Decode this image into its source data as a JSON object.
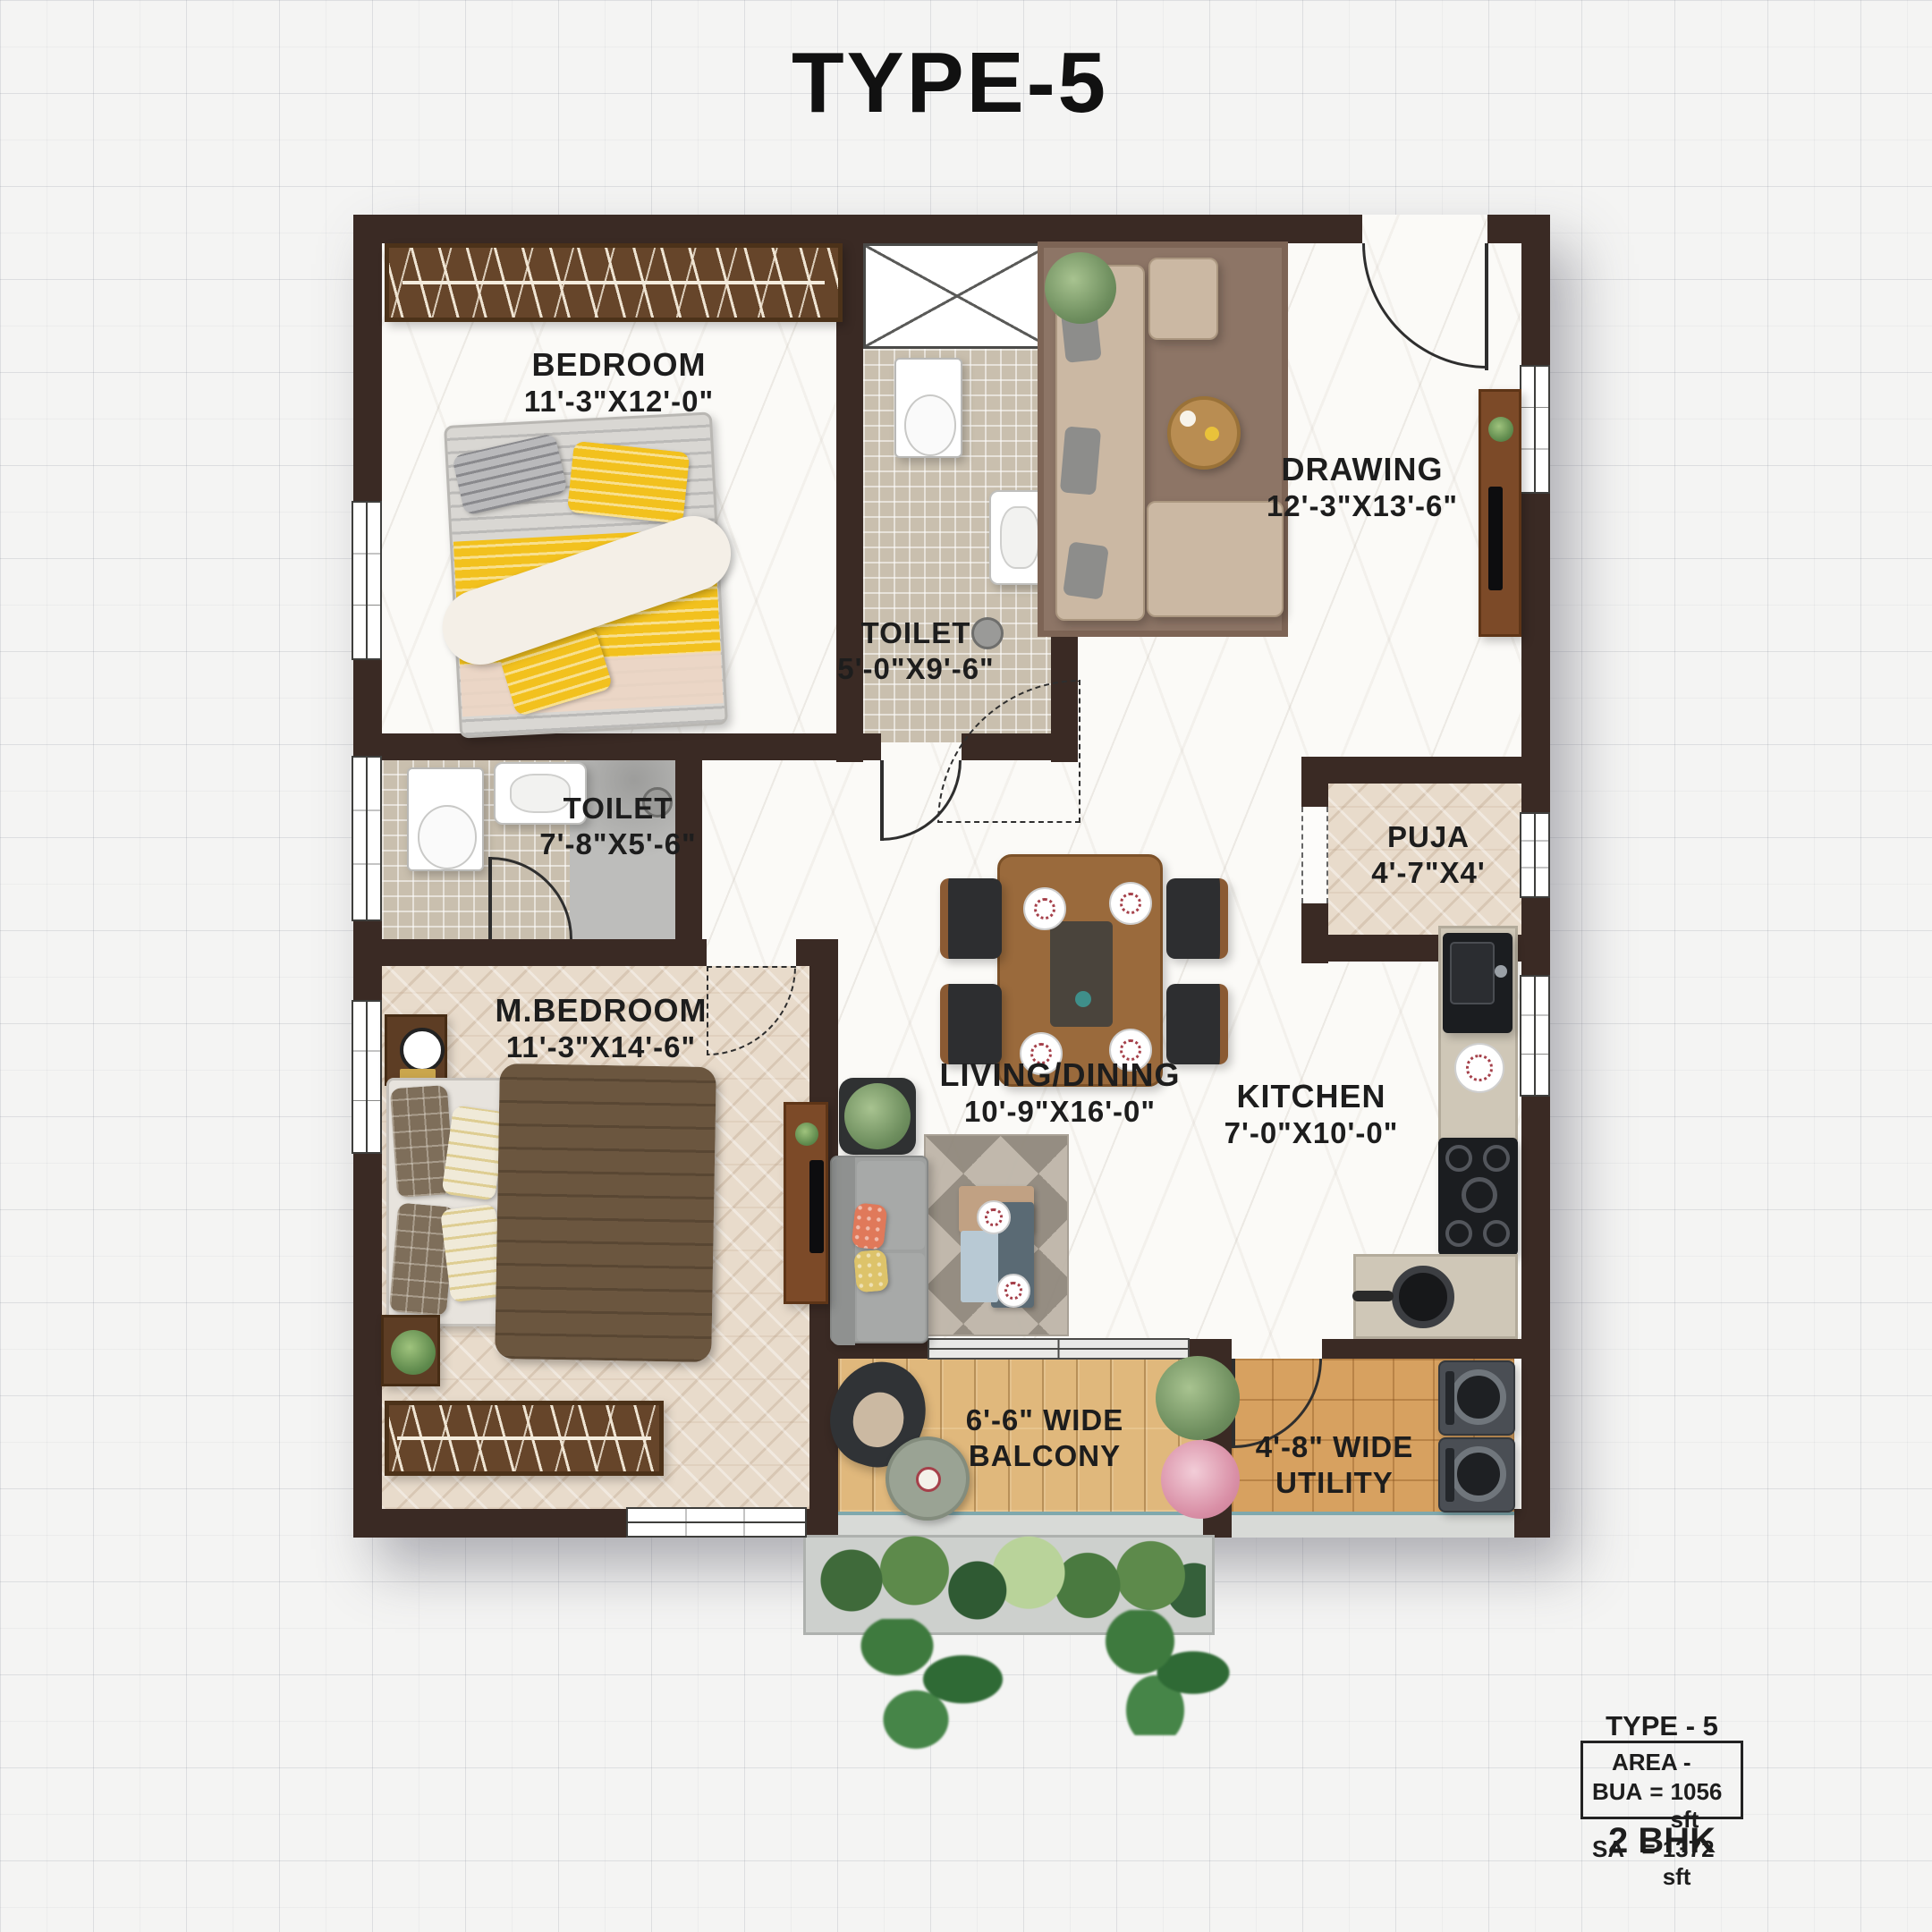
{
  "title": "TYPE-5",
  "rooms": {
    "bedroom": {
      "name": "BEDROOM",
      "dims": "11'-3\"X12'-0\""
    },
    "toilet_top": {
      "name": "TOILET",
      "dims": "5'-0\"X9'-6\""
    },
    "drawing": {
      "name": "DRAWING",
      "dims": "12'-3\"X13'-6\""
    },
    "toilet_left": {
      "name": "TOILET",
      "dims": "7'-8\"X5'-6\""
    },
    "puja": {
      "name": "PUJA",
      "dims": "4'-7\"X4'"
    },
    "master_bedroom": {
      "name": "M.BEDROOM",
      "dims": "11'-3\"X14'-6\""
    },
    "living_dining": {
      "name": "LIVING/DINING",
      "dims": "10'-9\"X16'-0\""
    },
    "kitchen": {
      "name": "KITCHEN",
      "dims": "7'-0\"X10'-0\""
    },
    "balcony": {
      "line1": "6'-6\" WIDE",
      "line2": "BALCONY"
    },
    "utility": {
      "line1": "4'-8\" WIDE",
      "line2": "UTILITY"
    }
  },
  "info_box": {
    "type_label": "TYPE - 5",
    "area_heading": "AREA -",
    "rows": [
      {
        "label": "BUA",
        "eq": "=",
        "value": "1056 sft"
      },
      {
        "label": "SA",
        "eq": "=",
        "value": "1372 sft"
      }
    ],
    "unit_type": "2 BHK"
  },
  "colors": {
    "wall": "#3a2a24",
    "marble_floor": "#fbfaf7",
    "herringbone_floor": "#e8dbcb",
    "deck_floor": "#e0b87c",
    "utility_floor": "#d7a160",
    "mosaic_floor": "#c9bfae",
    "accent_yellow": "#f2c11e",
    "accent_coral": "#e0795a",
    "sofa_beige": "#cbb8a3",
    "sofa_gray": "#9fa1a0",
    "wood_dark": "#66452a",
    "plant_green": "#6f8f5f"
  }
}
